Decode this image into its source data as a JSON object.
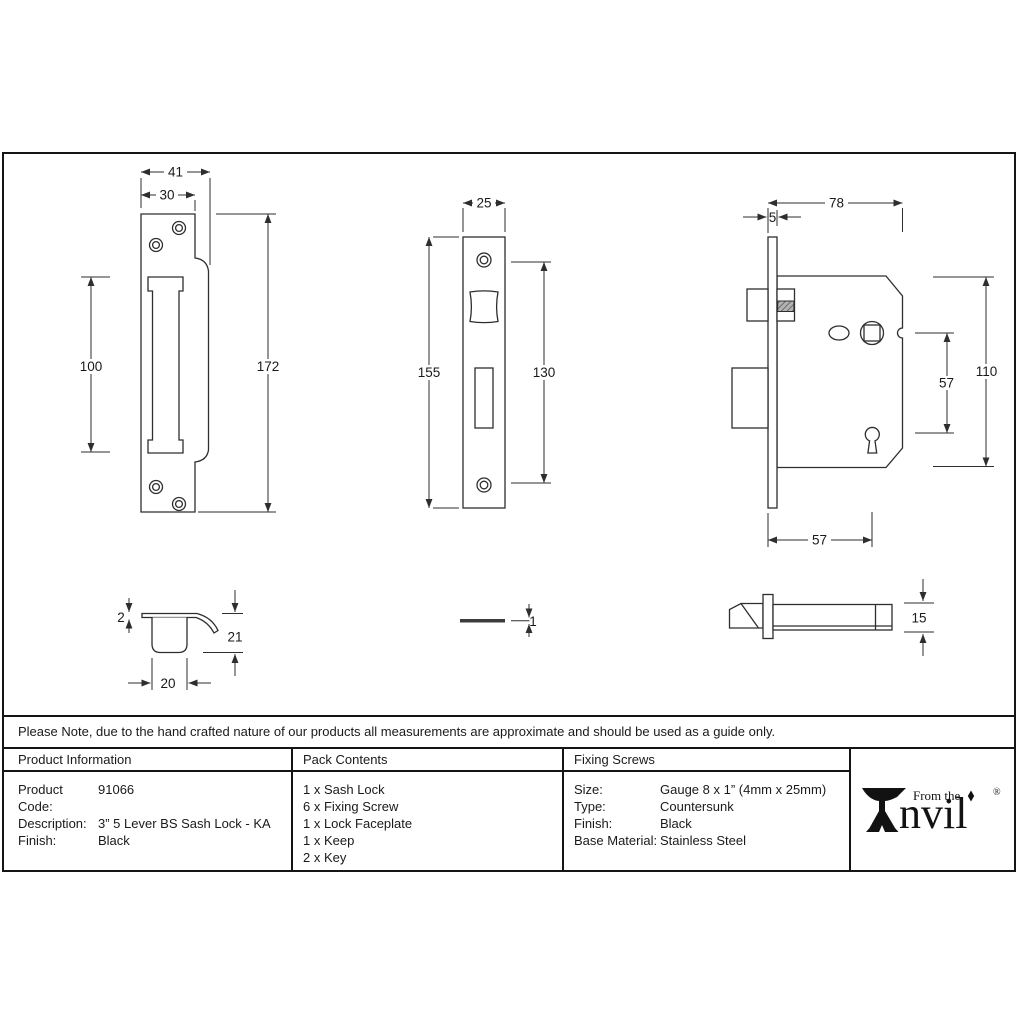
{
  "sheet": {
    "note": "Please Note, due to the hand crafted nature of our products all measurements are approximate and should be used as a guide only."
  },
  "drawings": {
    "keep_front": {
      "dim_width_outer": "41",
      "dim_width_plate": "30",
      "dim_slot_height": "100",
      "dim_total_height": "172"
    },
    "faceplate_front": {
      "dim_width": "25",
      "dim_total_height": "155",
      "dim_screw_span": "130"
    },
    "lock_body": {
      "dim_case_width": "78",
      "dim_faceplate_offset": "5",
      "dim_spindle_to_keyhole": "57",
      "dim_case_height": "110",
      "dim_backset": "57"
    },
    "keep_side": {
      "dim_plate_thickness": "2",
      "dim_depth": "21",
      "dim_box_width": "20"
    },
    "faceplate_side": {
      "dim_thickness": "1"
    },
    "lock_side": {
      "dim_case_depth": "15"
    }
  },
  "table": {
    "product_information": {
      "header": "Product Information",
      "rows": [
        {
          "label": "Product Code:",
          "value": "91066"
        },
        {
          "label": "Description:",
          "value": "3” 5 Lever BS Sash Lock - KA"
        },
        {
          "label": "Finish:",
          "value": "Black"
        }
      ]
    },
    "pack_contents": {
      "header": "Pack Contents",
      "items": [
        "1 x Sash Lock",
        "6 x Fixing Screw",
        "1 x Lock Faceplate",
        "1 x Keep",
        "2 x Key"
      ]
    },
    "fixing_screws": {
      "header": "Fixing Screws",
      "rows": [
        {
          "label": "Size:",
          "value": "Gauge 8 x 1” (4mm x 25mm)"
        },
        {
          "label": "Type:",
          "value": "Countersunk"
        },
        {
          "label": "Finish:",
          "value": "Black"
        },
        {
          "label": "Base Material:",
          "value": "Stainless Steel"
        }
      ]
    }
  },
  "brand": {
    "tagline": "From the",
    "name_rest": "nvil",
    "registered": "®"
  },
  "colors": {
    "line": "#2e2e2e",
    "border": "#151515",
    "text": "#1a1a1a",
    "background": "#ffffff",
    "hatch_fill": "#9a9a9a"
  }
}
